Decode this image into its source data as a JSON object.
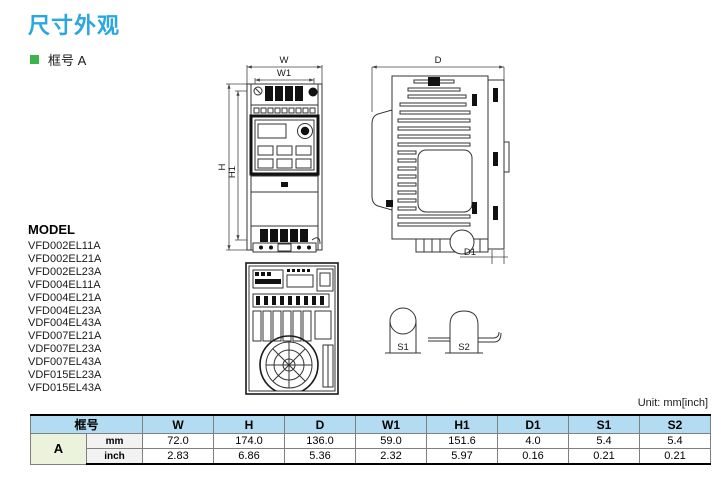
{
  "page": {
    "title": "尺寸外观",
    "section_bullet": "框号 A"
  },
  "models": {
    "header": "MODEL",
    "items": [
      "VFD002EL11A",
      "VFD002EL21A",
      "VFD002EL23A",
      "VFD004EL11A",
      "VFD004EL21A",
      "VFD004EL23A",
      "VDF004EL43A",
      "VFD007EL21A",
      "VDF007EL23A",
      "VDF007EL43A",
      "VDF015EL23A",
      "VFD015EL43A"
    ]
  },
  "drawings": {
    "front_view_labels": {
      "w": "W",
      "w1": "W1",
      "h": "H",
      "h1": "H1"
    },
    "side_view_labels": {
      "d": "D",
      "d1": "D1"
    },
    "mount_hole_labels": {
      "s1": "S1",
      "s2": "S2"
    }
  },
  "table": {
    "unit_note": "Unit: mm[inch]",
    "frame_header": "框号",
    "columns": [
      "W",
      "H",
      "D",
      "W1",
      "H1",
      "D1",
      "S1",
      "S2"
    ],
    "frame": "A",
    "rows": [
      {
        "unit": "mm",
        "values": [
          "72.0",
          "174.0",
          "136.0",
          "59.0",
          "151.6",
          "4.0",
          "5.4",
          "5.4"
        ]
      },
      {
        "unit": "inch",
        "values": [
          "2.83",
          "6.86",
          "5.36",
          "2.32",
          "5.97",
          "0.16",
          "0.21",
          "0.21"
        ]
      }
    ]
  },
  "colors": {
    "title_blue": "#2BA7E0",
    "bullet_green": "#3BB44A",
    "table_header_blue": "#B3DCF2",
    "frame_cell_green": "#EBF3DC",
    "unit_cell_gray": "#F2F2F2"
  }
}
